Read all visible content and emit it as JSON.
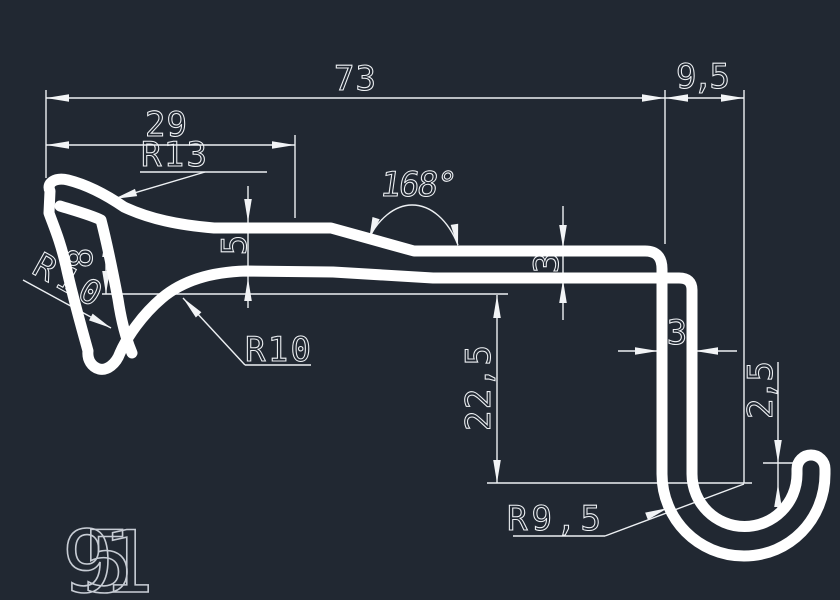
{
  "part_number": "951",
  "colors": {
    "background": "#212832",
    "profile_lines": "#ffffff",
    "dimension_lines": "#edf0f3",
    "part_label": "#c7ccd4"
  },
  "dimensions": {
    "overall_width": "73",
    "right_offset": "9,5",
    "left_section_width": "29",
    "top_radius": "R13",
    "bend_angle": "168°",
    "left_thickness": "5",
    "claw_notch_depth": "8",
    "claw_outer_radius": "R10",
    "claw_inner_radius": "R10",
    "wall_thickness_mid": "3",
    "hook_wall_thickness": "3",
    "hook_drop": "22,5",
    "hook_tip_rise": "2,5",
    "hook_radius": "R9,5"
  }
}
